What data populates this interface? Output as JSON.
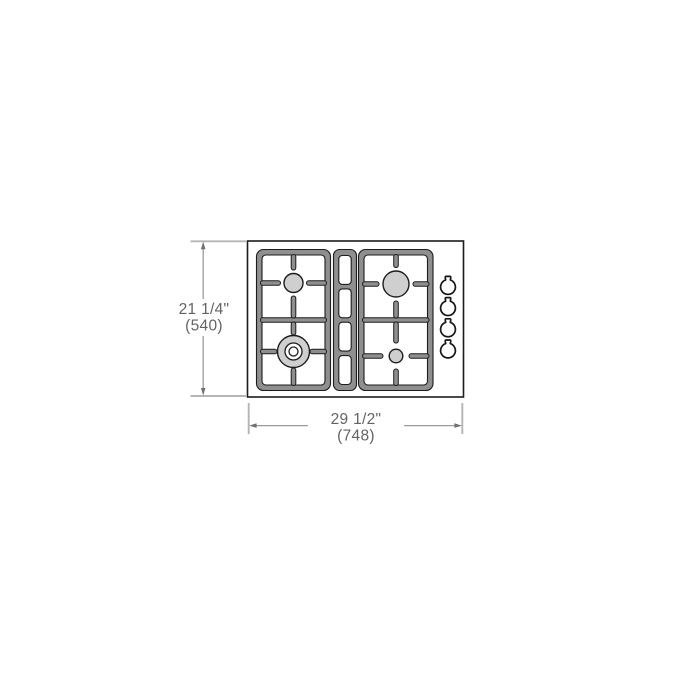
{
  "diagram": {
    "kind": "technical-installation-drawing",
    "view": "gas-cooktop-top-view",
    "width_dim": {
      "inches": "29 1/2\"",
      "mm": "(748)"
    },
    "height_dim": {
      "inches": "21 1/4\"",
      "mm": "(540)"
    },
    "burners": [
      {
        "name": "rear-left-burner",
        "style": "medium-circle"
      },
      {
        "name": "front-left-burner",
        "style": "dual-ring-wok-burner"
      },
      {
        "name": "rear-right-burner",
        "style": "large-circle"
      },
      {
        "name": "front-right-burner",
        "style": "small-circle"
      }
    ],
    "grates": {
      "left": 1,
      "center_strip_slots": 4,
      "right": 1
    },
    "knobs": {
      "count": 4
    },
    "colors": {
      "grate": "#8f8f8f",
      "burner": "#cfcfcf",
      "outline": "#1c1c1c",
      "dim_line": "#9b9b9b",
      "ext_line": "#b5b5b5",
      "arrow": "#707070",
      "dim_text": "#636363",
      "background": "#ffffff"
    }
  }
}
